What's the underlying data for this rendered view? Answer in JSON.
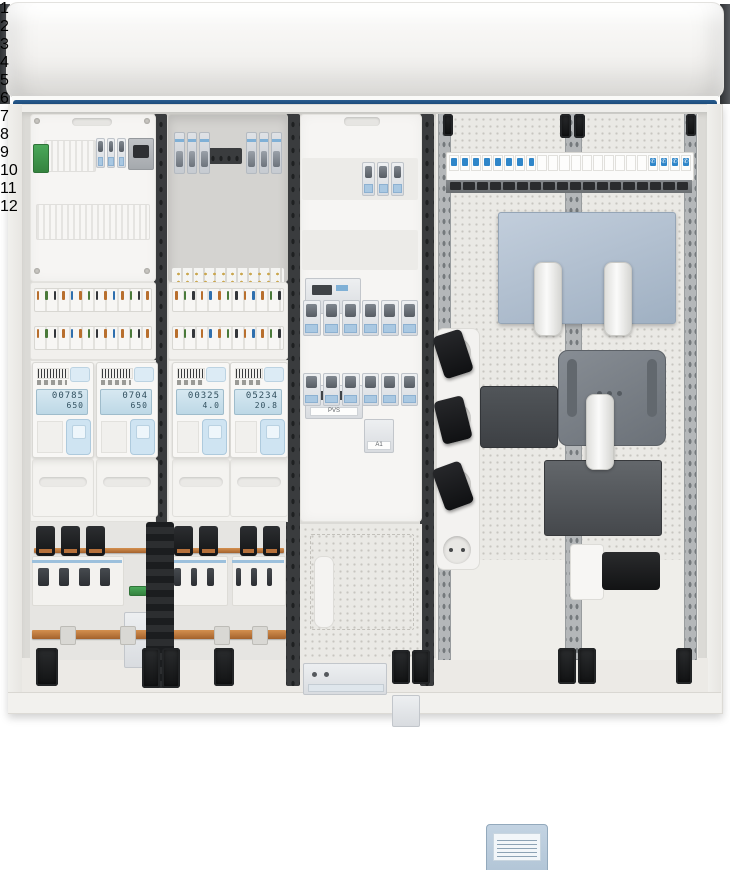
{
  "scene": {
    "description": "Open wall-mounted electrical distribution and multimedia cabinet with rolled hood cover, blue design strip and twelve numbered component callouts"
  },
  "colors": {
    "callout_orange": "#E5601A",
    "callout_blue": "#27A4D9",
    "design_strip_navy": "#1D4E7F",
    "busbar_copper": "#B5703A",
    "wire_blue": "#3A7FC1",
    "wire_green_yellow": "#8FAE36",
    "meter_lcd": "#C9DEEA",
    "router_bluegray": "#B5C3D4"
  },
  "callouts": [
    {
      "number": "1",
      "style": "orange",
      "x": 48,
      "y": 436
    },
    {
      "number": "2",
      "style": "orange",
      "x": 110,
      "y": 436
    },
    {
      "number": "3",
      "style": "orange",
      "x": 184,
      "y": 436
    },
    {
      "number": "4",
      "style": "orange",
      "x": 247,
      "y": 436
    },
    {
      "number": "5",
      "style": "orange",
      "x": 76,
      "y": 369
    },
    {
      "number": "6",
      "style": "orange",
      "x": 140,
      "y": 293
    },
    {
      "number": "7",
      "style": "orange",
      "x": 36,
      "y": 132
    },
    {
      "number": "8",
      "style": "orange",
      "x": 78,
      "y": 638
    },
    {
      "number": "9",
      "style": "orange",
      "x": 104,
      "y": 572
    },
    {
      "number": "10",
      "style": "orange",
      "x": 113,
      "y": 636
    },
    {
      "number": "11",
      "style": "blue",
      "x": 171,
      "y": 633
    },
    {
      "number": "12",
      "style": "orange",
      "x": 401,
      "y": 554
    }
  ],
  "meters": [
    {
      "id": "1",
      "lcd_line1": "00785",
      "lcd_line2": "650",
      "x": 32,
      "y": 362,
      "w": 60
    },
    {
      "id": "2",
      "lcd_line1": "0704",
      "lcd_line2": "650",
      "x": 96,
      "y": 362,
      "w": 60
    },
    {
      "id": "3",
      "lcd_line1": "00325",
      "lcd_line2": "4.0",
      "x": 172,
      "y": 362,
      "w": 56
    },
    {
      "id": "4",
      "lcd_line1": "05234",
      "lcd_line2": "20.8",
      "x": 230,
      "y": 362,
      "w": 56
    }
  ],
  "labels": {
    "pvs_device": "PVS",
    "a1_device": "A1",
    "ce_mark": "CE"
  },
  "patch_panel": {
    "data_modules": 8,
    "blank_modules": 10,
    "phone_modules": 4,
    "phone_icon": "✆"
  }
}
